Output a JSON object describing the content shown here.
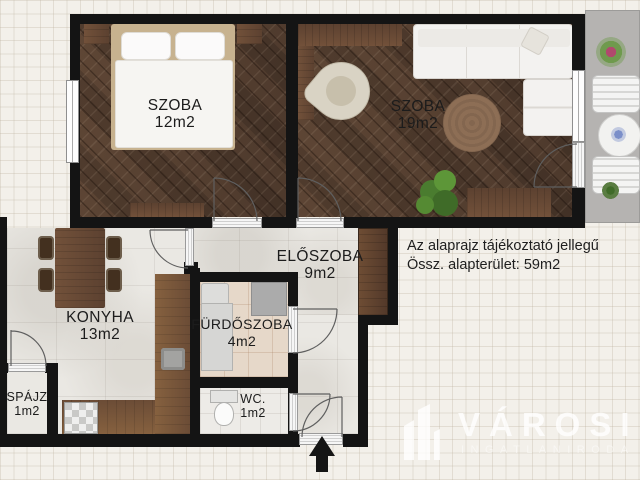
{
  "plan": {
    "rooms": [
      {
        "name": "SZOBA",
        "area": "12m2"
      },
      {
        "name": "SZOBA",
        "area": "19m2"
      },
      {
        "name": "ELŐSZOBA",
        "area": "9m2"
      },
      {
        "name": "KONYHA",
        "area": "13m2"
      },
      {
        "name": "FÜRDŐSZOBA",
        "area": "4m2"
      },
      {
        "name": "WC.",
        "area": "1m2"
      },
      {
        "name": "SPÁJZ",
        "area": "1m2"
      }
    ],
    "disclaimer": "Az alaprajz tájékoztató jellegű",
    "total_area": "Össz. alapterület: 59m2"
  },
  "watermark": {
    "brand": "VÁROSI",
    "subtitle": "INGATLANIRODA",
    "icon": "buildings-icon"
  },
  "icons": {
    "entrance": "arrow-up-icon"
  },
  "colors": {
    "wall": "#141414",
    "wood_floor": "#553e30",
    "stone_floor": "#eae8e3",
    "bath_floor": "#e6d8c9",
    "balcony": "#b5b3b1",
    "furniture_wood": "#6a4a33",
    "label_text": "#1c1c1c",
    "watermark": "#ffffff"
  }
}
